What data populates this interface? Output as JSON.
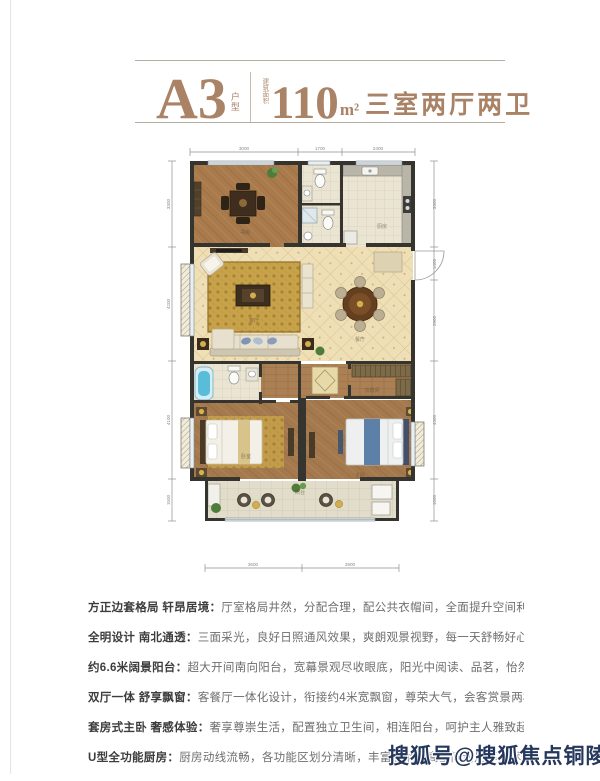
{
  "header": {
    "plan_code": "A3",
    "plan_code_suffix": "户型",
    "area_prefix": "建筑面积",
    "area_value": "110",
    "area_unit": "m²",
    "area_desc": "三室两厅两卫",
    "accent_color": "#aa8266"
  },
  "floorplan": {
    "dimensions": {
      "top": [
        "3000",
        "1700",
        "2400"
      ],
      "bottom": [
        "3600",
        "2900"
      ],
      "left": [
        "3300",
        "4200",
        "4100",
        "1500"
      ],
      "right": [
        "3300",
        "1400",
        "2900",
        "4300",
        "1500"
      ]
    },
    "rooms": [
      {
        "label": "书房"
      },
      {
        "label": "厨房"
      },
      {
        "label": "客厅"
      },
      {
        "label": "餐厅"
      },
      {
        "label": "衣帽间"
      },
      {
        "label": "卧室"
      },
      {
        "label": "主卧"
      },
      {
        "label": "阳台"
      }
    ],
    "colors": {
      "wall": "#35342f",
      "wood_floor": "#a87a4c",
      "tile_floor": "#eedfb6",
      "carpet_gold": "#c7a24b",
      "bathtub_blue": "#59bcd9",
      "bed_blue": "#5d80a8"
    }
  },
  "features": [
    {
      "title": "方正边套格局 轩昂居境：",
      "desc": "厅室格局井然，分配合理，配公共衣帽间，全面提升空间利用率。"
    },
    {
      "title": "全明设计 南北通透：",
      "desc": "三面采光，良好日照通风效果，爽朗观景视野，每一天舒畅好心情。"
    },
    {
      "title": "约6.6米阔景阳台：",
      "desc": "超大开间南向阳台，宽幕景观尽收眼底，阳光中阅读、品茗，怡然自得。"
    },
    {
      "title": "双厅一体 舒享飘窗：",
      "desc": "客餐厅一体化设计，衔接约4米宽飘窗，尊荣大气，会客赏景两相宜。"
    },
    {
      "title": "套房式主卧 奢感体验：",
      "desc": "奢享尊崇生活，配置独立卫生间，相连阳台，呵护主人雅致起居。"
    },
    {
      "title": "U型全功能厨房：",
      "desc": "厨房动线流畅，各功能区划分清晰，丰富收纳，高空间利用率，尽情施展厨艺。"
    }
  ],
  "watermark": {
    "text": "搜狐号@搜狐焦点铜陵站",
    "color": "#25385c"
  }
}
